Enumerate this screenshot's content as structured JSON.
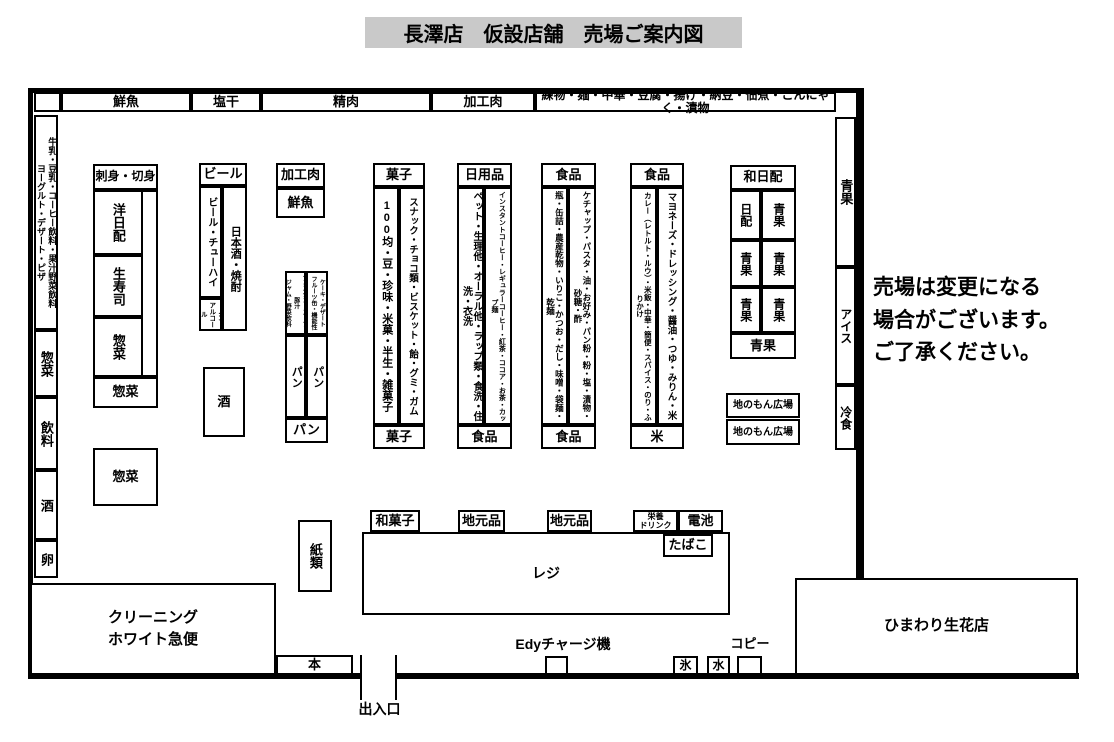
{
  "title": "長澤店　仮設店舗　売場ご案内図",
  "notice": "売場は変更になる\n場合がございます。\nご了承ください。",
  "colors": {
    "title_bg": "#c9c9c9",
    "line": "#000000",
    "bg": "#ffffff"
  },
  "top_row": {
    "fresh_fish": "鮮魚",
    "salted_dried": "塩干",
    "meat": "精肉",
    "processed_meat": "加工肉",
    "neri_etc": "練物・麺・中華・豆腐・揚げ・納豆・佃煮・こんにゃく・漬物"
  },
  "left_wall": {
    "milk_dairy": "牛乳・豆乳・コーヒー飲料・果汁野菜飲料\nヨーグルト・デザート・ピザ",
    "souzai": "惣菜",
    "beverages": "飲料",
    "sake": "酒",
    "eggs": "卵"
  },
  "left_aisle": {
    "sashimi": "刺身・切身",
    "western_daily": "洋日配",
    "fresh_sushi": "生寿司",
    "souzai_v": "惣菜",
    "souzai_wide": "惣菜",
    "souzai_square": "惣菜"
  },
  "liquor": {
    "beer_top": "ビール",
    "beer_chuhai": "ビール・チューハイ",
    "non_alcohol": "ノン\nアルコール",
    "nihonshu_shochu": "日本酒・焼酎",
    "sake_box": "酒"
  },
  "meat_corner": {
    "processed_meat": "加工肉",
    "fresh_fish": "鮮魚"
  },
  "bread": {
    "header_left": "インスタントスープ・豚汁\nジャム・野菜飲料",
    "header_right": "ケーキ・デザート\nフルーツ缶・機能性",
    "pan_left": "パン",
    "pan_right": "パン",
    "pan_bottom": "パン"
  },
  "snacks": {
    "top": "菓子",
    "left": "100均・豆・珍味・米菓・半生・雑菓子",
    "right": "スナック・チョコ類・ビスケット・飴・グミ・ガム",
    "bottom": "菓子"
  },
  "daily_goods": {
    "top": "日用品",
    "left": "ペット・生理他・オーラル他・ラップ類・食洗・住洗・衣洗",
    "right": "インスタントコーヒー・レギュラーコーヒー・紅茶・ココア・お茶・カップ麺",
    "bottom": "食品"
  },
  "food1": {
    "top": "食品",
    "left": "瓶・缶詰・農産乾物・いりこ・かつお・だし・味噌・袋麺・乾麺",
    "right": "ケチャップ・パスタ・油・お好み・パン粉・粉・塩・漬物・砂糖・酢",
    "bottom": "食品"
  },
  "food2": {
    "top": "食品",
    "left": "カレー（レトルト・ルウ）・米飯・中華・簡便・スパイス・のり・ふりかけ",
    "right": "マヨネーズ・ドレッシング・醤油・つゆ・みりん・米",
    "bottom": "米"
  },
  "wa_nippai": {
    "top": "和日配",
    "cells": [
      "日配",
      "青果",
      "青果",
      "青果",
      "青果",
      "青果"
    ],
    "bottom": "青果",
    "local1": "地のもん広場",
    "local2": "地のもん広場"
  },
  "right_wall": {
    "produce": "青果",
    "ice_cream": "アイス",
    "frozen": "冷食"
  },
  "checkout": {
    "paper": "紙類",
    "register": "レジ",
    "wagashi": "和菓子",
    "local1": "地元品",
    "local2": "地元品",
    "energy_drink": "栄養\nドリンク",
    "battery": "電池",
    "tobacco": "たばこ"
  },
  "bottom": {
    "cleaning": "クリーニング\nホワイト急便",
    "books": "本",
    "entrance": "出入口",
    "edy": "Edyチャージ機",
    "ice": "氷",
    "water": "水",
    "copy": "コピー",
    "flower_shop": "ひまわり生花店"
  }
}
